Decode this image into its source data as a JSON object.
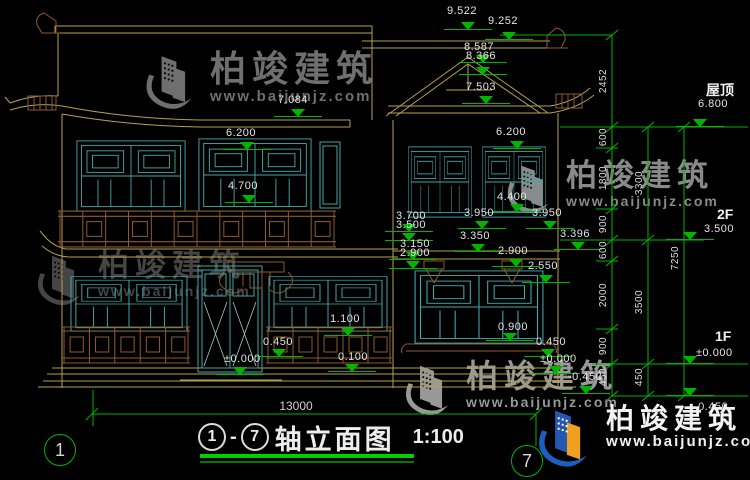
{
  "title": {
    "from": "1",
    "dash": "-",
    "to": "7",
    "name": "轴立面图",
    "scale": "1:100"
  },
  "watermark": {
    "brand": "柏竣建筑",
    "url": "www.baijunjz.com"
  },
  "floor_labels": [
    {
      "t": "屋顶",
      "x": 706,
      "y": 83
    },
    {
      "t": "2F",
      "x": 717,
      "y": 207
    },
    {
      "t": "1F",
      "x": 715,
      "y": 329
    }
  ],
  "axis_bubbles": [
    {
      "t": "1",
      "cx": 60,
      "cy": 450
    },
    {
      "t": "7",
      "cx": 527,
      "cy": 461
    }
  ],
  "annotations": {
    "levels": [
      {
        "t": "9.522",
        "x": 447,
        "y": 6,
        "ax": 468,
        "ay": 30
      },
      {
        "t": "9.252",
        "x": 488,
        "y": 16,
        "ax": 509,
        "ay": 40
      },
      {
        "t": "8.587",
        "x": 464,
        "y": 42,
        "ax": 483,
        "ay": 63
      },
      {
        "t": "8.366",
        "x": 466,
        "y": 51,
        "ax": 483,
        "ay": 75
      },
      {
        "t": "7.503",
        "x": 466,
        "y": 82,
        "ax": 486,
        "ay": 104
      },
      {
        "t": "7.084",
        "x": 278,
        "y": 95,
        "ax": 298,
        "ay": 117
      },
      {
        "t": "6.200",
        "x": 226,
        "y": 128,
        "ax": 247,
        "ay": 150
      },
      {
        "t": "6.200",
        "x": 496,
        "y": 127,
        "ax": 517,
        "ay": 149
      },
      {
        "t": "4.700",
        "x": 228,
        "y": 181,
        "ax": 249,
        "ay": 203
      },
      {
        "t": "4.400",
        "x": 497,
        "y": 192,
        "ax": 517,
        "ay": 212
      },
      {
        "t": "3.950",
        "x": 464,
        "y": 208,
        "ax": 482,
        "ay": 229
      },
      {
        "t": "3.950",
        "x": 532,
        "y": 208,
        "ax": 550,
        "ay": 229
      },
      {
        "t": "3.700",
        "x": 396,
        "y": 211,
        "ax": 409,
        "ay": 232
      },
      {
        "t": "3.500",
        "x": 396,
        "y": 220,
        "ax": 409,
        "ay": 241
      },
      {
        "t": "3.150",
        "x": 400,
        "y": 239,
        "ax": 413,
        "ay": 260
      },
      {
        "t": "2.900",
        "x": 400,
        "y": 248,
        "ax": 413,
        "ay": 269
      },
      {
        "t": "3.350",
        "x": 460,
        "y": 231,
        "ax": 478,
        "ay": 252
      },
      {
        "t": "3.396",
        "x": 560,
        "y": 229,
        "ax": 578,
        "ay": 250
      },
      {
        "t": "2.900",
        "x": 498,
        "y": 246,
        "ax": 516,
        "ay": 267
      },
      {
        "t": "2.550",
        "x": 528,
        "y": 261,
        "ax": 546,
        "ay": 283
      },
      {
        "t": "1.100",
        "x": 330,
        "y": 314,
        "ax": 348,
        "ay": 336
      },
      {
        "t": "0.450",
        "x": 263,
        "y": 337,
        "ax": 279,
        "ay": 357
      },
      {
        "t": "±0.000",
        "x": 224,
        "y": 354,
        "ax": 240,
        "ay": 375
      },
      {
        "t": "0.100",
        "x": 338,
        "y": 352,
        "ax": 352,
        "ay": 372
      },
      {
        "t": "0.900",
        "x": 498,
        "y": 322,
        "ax": 510,
        "ay": 341
      },
      {
        "t": "0.450",
        "x": 536,
        "y": 337,
        "ax": 548,
        "ay": 357
      },
      {
        "t": "±0.000",
        "x": 540,
        "y": 354,
        "ax": 556,
        "ay": 374
      },
      {
        "t": "-0.450",
        "x": 568,
        "y": 372,
        "ax": 586,
        "ay": 394
      },
      {
        "t": "6.800",
        "x": 698,
        "y": 99,
        "ax": 700,
        "ay": 127
      },
      {
        "t": "3.500",
        "x": 704,
        "y": 224,
        "ax": 690,
        "ay": 240
      },
      {
        "t": "±0.000",
        "x": 696,
        "y": 348,
        "ax": 690,
        "ay": 364
      },
      {
        "t": "-0.450",
        "x": 694,
        "y": 402,
        "ax": 690,
        "ay": 396
      }
    ],
    "vdims": [
      {
        "t": "2452",
        "x": 604,
        "y": 81
      },
      {
        "t": "600",
        "x": 604,
        "y": 137
      },
      {
        "t": "1800",
        "x": 604,
        "y": 178
      },
      {
        "t": "900",
        "x": 604,
        "y": 224
      },
      {
        "t": "600",
        "x": 604,
        "y": 250
      },
      {
        "t": "2000",
        "x": 604,
        "y": 295
      },
      {
        "t": "900",
        "x": 604,
        "y": 346
      },
      {
        "t": "450",
        "x": 604,
        "y": 377
      },
      {
        "t": "3300",
        "x": 640,
        "y": 183
      },
      {
        "t": "3500",
        "x": 640,
        "y": 302
      },
      {
        "t": "450",
        "x": 640,
        "y": 377
      },
      {
        "t": "7250",
        "x": 676,
        "y": 258
      }
    ],
    "hdims": [
      {
        "t": "13000",
        "x": 296,
        "y": 406
      }
    ]
  },
  "colors": {
    "background": "#000000",
    "dimension_green": "#00b400",
    "structure_yellow": "#b3a24c",
    "window_teal": "#3fa8a8",
    "wood_brown": "#8f5a2d",
    "text_white": "#e4e4e4",
    "logo_blue": "#1d5fc0",
    "logo_orange": "#f0a020"
  }
}
